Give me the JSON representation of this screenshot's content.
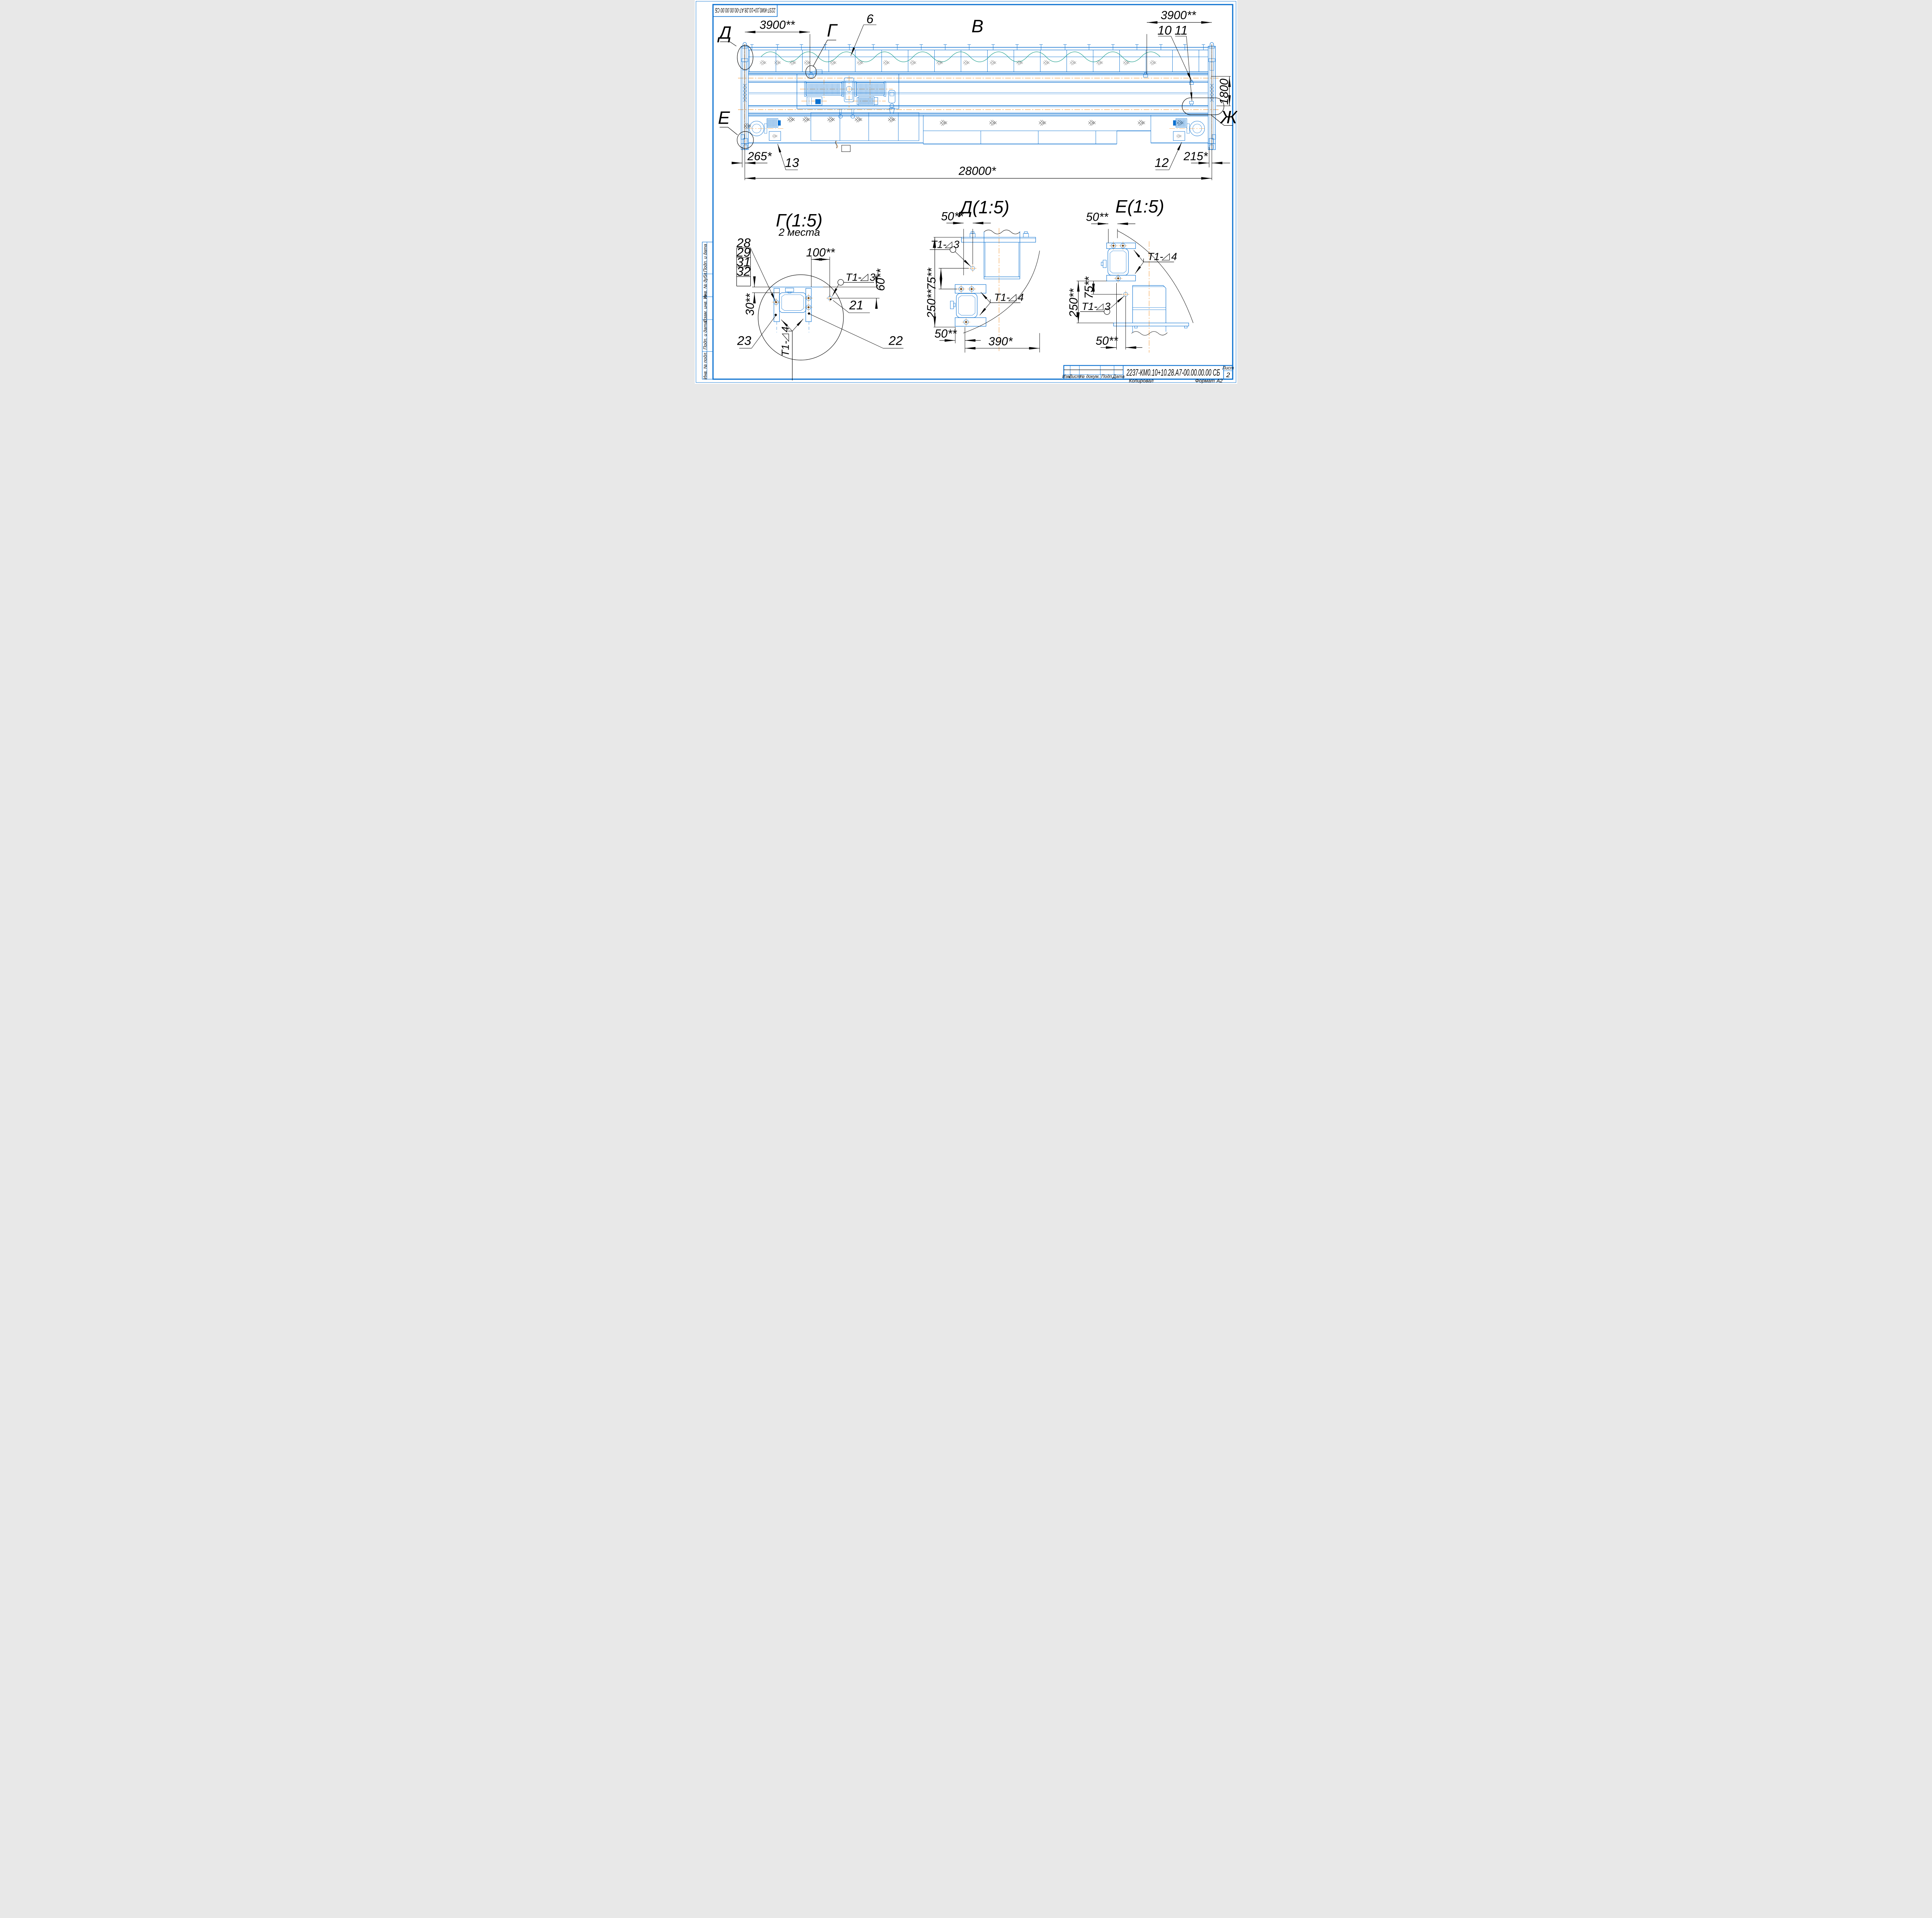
{
  "sheet": {
    "top_designation": "2237-КМ0,10+10.28.А7-00.00.00.00 СБ"
  },
  "side_strip": {
    "items": [
      "Подп. и дата",
      "Инв. № дубл.",
      "Взам. инв. №",
      "Подп. и дата",
      "Инв. № подл."
    ]
  },
  "title_block": {
    "designation": "2237-КМ0.10+10.28.А7-00.00.00.00 СБ",
    "cols": {
      "izm": "Изм.",
      "list": "Лист",
      "doc": "№ докум.",
      "podp": "Подп.",
      "data": "Дата"
    },
    "sheet_label": "Лист",
    "sheet_number": "2",
    "footer": {
      "kopiroval": "Копировал",
      "format_label": "Формат",
      "format_value": "А2"
    }
  },
  "main_view": {
    "label": "В",
    "markers": {
      "d": "Д",
      "g": "Г",
      "e": "Е",
      "zh": "Ж"
    },
    "dims": {
      "span_left": "3900**",
      "span_right": "3900**",
      "gauge": "1800",
      "left_offset": "265*",
      "right_offset": "215*",
      "total": "28000*"
    },
    "positions": {
      "p6": "6",
      "p10": "10",
      "p11": "11",
      "p12": "12",
      "p13": "13"
    }
  },
  "detail_g": {
    "title": "Г(1:5)",
    "note": "2 места",
    "stack": [
      "28",
      "29",
      "31",
      "32"
    ],
    "dims": {
      "d100": "100**",
      "d60": "60**",
      "d30": "30**"
    },
    "positions": {
      "p21": "21",
      "p22": "22",
      "p23": "23"
    }
  },
  "detail_d": {
    "title": "Д(1:5)",
    "dims": {
      "top": "50**",
      "v75": "75**",
      "v250": "250**",
      "bottom": "50**",
      "width": "390*"
    }
  },
  "detail_e": {
    "title": "Е(1:5)",
    "dims": {
      "top": "50**",
      "v75": "75**",
      "v250": "250**",
      "bottom": "50**"
    }
  },
  "weld": {
    "prefix": "Т1-",
    "grade3": "3",
    "grade4": "4"
  }
}
